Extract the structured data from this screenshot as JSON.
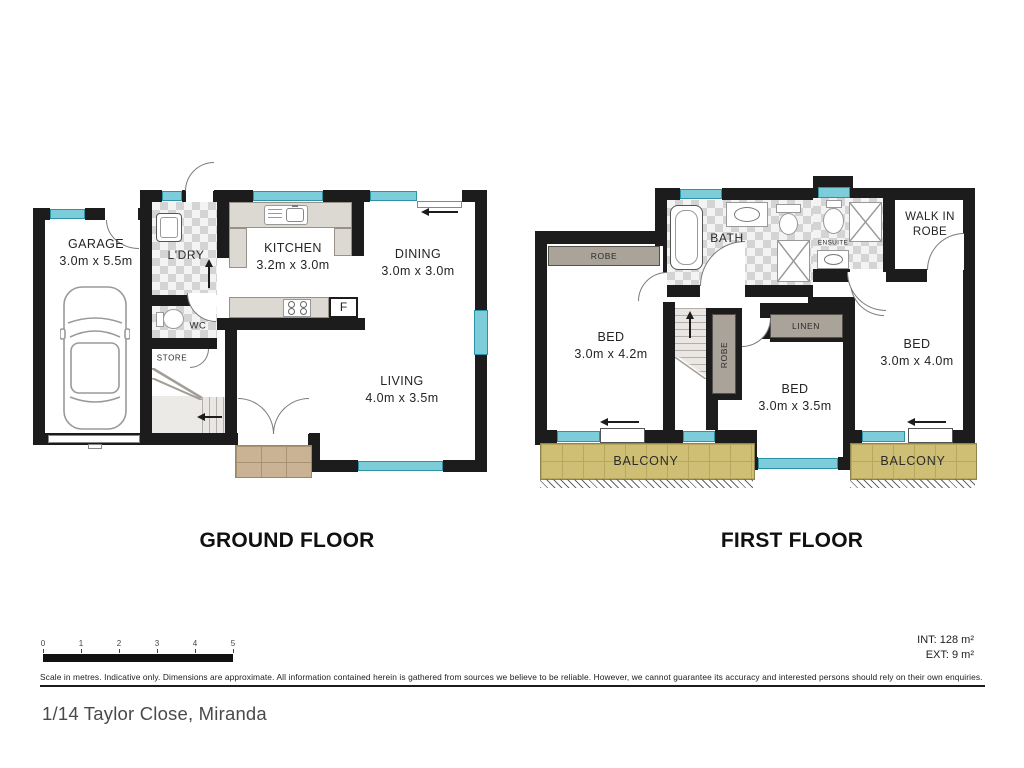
{
  "titles": {
    "ground": "GROUND FLOOR",
    "first": "FIRST FLOOR"
  },
  "address": "1/14 Taylor Close, Miranda",
  "areas": {
    "int": "INT: 128 m²",
    "ext": "EXT: 9 m²"
  },
  "disclaimer": "Scale in metres. Indicative only. Dimensions are approximate. All information contained herein is gathered from sources we believe to be reliable. However, we cannot guarantee its accuracy and interested persons should rely on their own enquiries.",
  "scale_bar": {
    "ticks": [
      "0",
      "1",
      "2",
      "3",
      "4",
      "5"
    ]
  },
  "ground": {
    "garage": {
      "name": "GARAGE",
      "dims": "3.0m x 5.5m"
    },
    "ldry": {
      "name": "L'DRY"
    },
    "wc": {
      "name": "WC"
    },
    "store": {
      "name": "STORE"
    },
    "kitchen": {
      "name": "KITCHEN",
      "dims": "3.2m x 3.0m"
    },
    "dining": {
      "name": "DINING",
      "dims": "3.0m x 3.0m"
    },
    "living": {
      "name": "LIVING",
      "dims": "4.0m x 3.5m"
    },
    "fridge_label": "F"
  },
  "first": {
    "bed1": {
      "name": "BED",
      "dims": "3.0m x 4.2m"
    },
    "bed2": {
      "name": "BED",
      "dims": "3.0m x 3.5m"
    },
    "bed3": {
      "name": "BED",
      "dims": "3.0m x 4.0m"
    },
    "bath": {
      "name": "BATH"
    },
    "ensuite": {
      "name": "ENSUITE"
    },
    "walk_in_robe": {
      "line1": "WALK IN",
      "line2": "ROBE"
    },
    "robe_strip": "ROBE",
    "robe_tall": "ROBE",
    "linen": "LINEN",
    "balcony_left": "BALCONY",
    "balcony_right": "BALCONY"
  },
  "colors": {
    "wall": "#1c1c1c",
    "window": "#7dccd9",
    "balcony_tile": "#cebf74",
    "porch_brick": "#c9b394",
    "tile_checker": "#d4d4d4"
  }
}
